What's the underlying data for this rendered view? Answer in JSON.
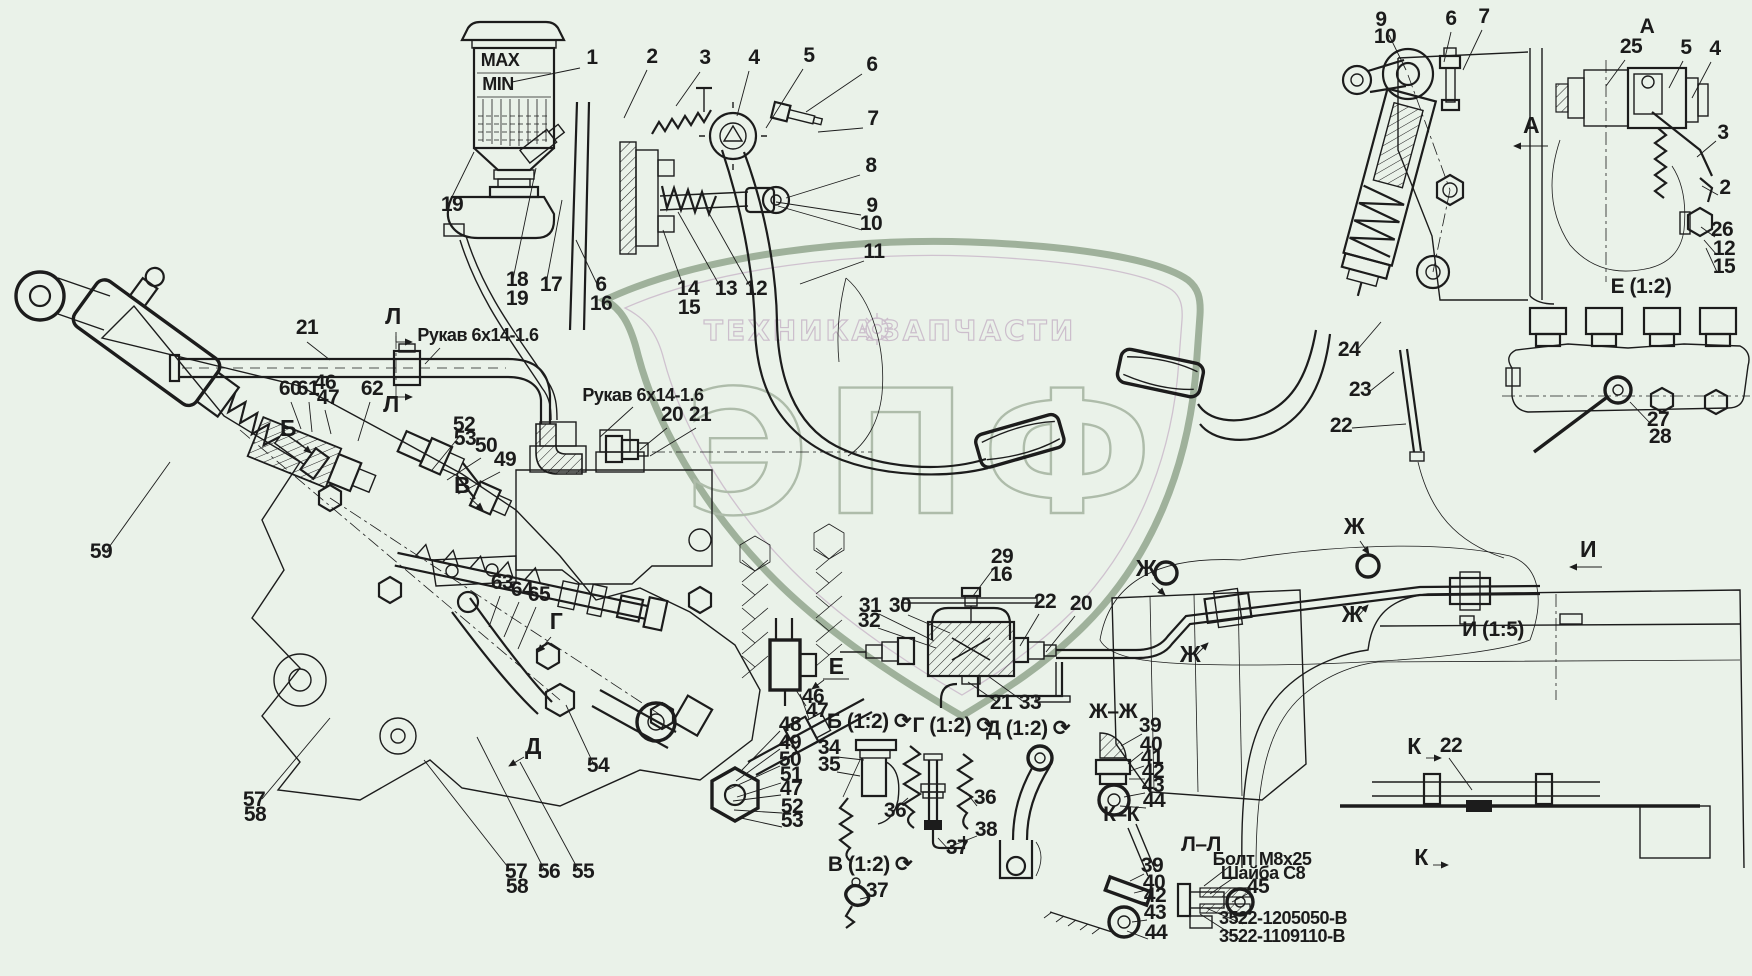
{
  "page": {
    "bg": "#eaf2e9",
    "ink": "#1b1b1b",
    "kind": "technical parts diagram"
  },
  "watermark": {
    "brand_left": "ТЕХНИКА",
    "brand_right": "ЗАПЧАСТИ",
    "logo_letters": "ЭПФ",
    "shield_color": "#9fb19b",
    "text_color": "#ccbecc",
    "letters_color": "#aebcaa",
    "gear_icon": "gear-icon"
  },
  "annotations": {
    "part_labels": [
      [
        "1",
        592,
        64
      ],
      [
        "2",
        652,
        63
      ],
      [
        "3",
        705,
        64
      ],
      [
        "4",
        754,
        64
      ],
      [
        "5",
        809,
        62
      ],
      [
        "6",
        872,
        71
      ],
      [
        "7",
        873,
        125
      ],
      [
        "8",
        871,
        172
      ],
      [
        "9",
        872,
        212
      ],
      [
        "10",
        871,
        230
      ],
      [
        "11",
        874,
        258
      ],
      [
        "12",
        756,
        295
      ],
      [
        "13",
        726,
        295
      ],
      [
        "14",
        688,
        295
      ],
      [
        "15",
        689,
        314
      ],
      [
        "6",
        601,
        291
      ],
      [
        "16",
        601,
        310
      ],
      [
        "17",
        551,
        291
      ],
      [
        "18",
        517,
        286
      ],
      [
        "19",
        517,
        305
      ],
      [
        "19",
        452,
        211
      ],
      [
        "21",
        307,
        334
      ],
      [
        "59",
        101,
        558
      ],
      [
        "60",
        290,
        395
      ],
      [
        "61",
        308,
        395
      ],
      [
        "46",
        325,
        389
      ],
      [
        "47",
        328,
        404
      ],
      [
        "62",
        372,
        395
      ],
      [
        "52",
        464,
        431
      ],
      [
        "53",
        465,
        445
      ],
      [
        "50",
        486,
        452
      ],
      [
        "49",
        505,
        466
      ],
      [
        "63",
        502,
        589
      ],
      [
        "64",
        522,
        596
      ],
      [
        "65",
        539,
        601
      ],
      [
        "54",
        598,
        772
      ],
      [
        "57",
        254,
        806
      ],
      [
        "58",
        255,
        821
      ],
      [
        "57",
        516,
        878
      ],
      [
        "58",
        517,
        893
      ],
      [
        "56",
        549,
        878
      ],
      [
        "55",
        583,
        878
      ],
      [
        "48",
        790,
        731
      ],
      [
        "49",
        790,
        749
      ],
      [
        "50",
        790,
        766
      ],
      [
        "51",
        791,
        781
      ],
      [
        "47",
        791,
        795
      ],
      [
        "52",
        792,
        813
      ],
      [
        "53",
        792,
        827
      ],
      [
        "46",
        813,
        703
      ],
      [
        "47",
        817,
        717
      ],
      [
        "34",
        829,
        754
      ],
      [
        "35",
        829,
        771
      ],
      [
        "36",
        895,
        817
      ],
      [
        "36",
        985,
        804
      ],
      [
        "38",
        986,
        836
      ],
      [
        "37",
        957,
        854
      ],
      [
        "37",
        877,
        897
      ],
      [
        "29",
        1002,
        563
      ],
      [
        "16",
        1001,
        581
      ],
      [
        "31",
        870,
        612
      ],
      [
        "32",
        869,
        627
      ],
      [
        "30",
        900,
        612
      ],
      [
        "22",
        1045,
        608
      ],
      [
        "20",
        1081,
        610
      ],
      [
        "21",
        1001,
        709
      ],
      [
        "33",
        1030,
        709
      ],
      [
        "20",
        672,
        421
      ],
      [
        "21",
        700,
        421
      ],
      [
        "39",
        1150,
        732
      ],
      [
        "40",
        1151,
        751
      ],
      [
        "41",
        1152,
        764
      ],
      [
        "42",
        1153,
        778
      ],
      [
        "43",
        1153,
        792
      ],
      [
        "44",
        1154,
        807
      ],
      [
        "39",
        1152,
        872
      ],
      [
        "40",
        1154,
        889
      ],
      [
        "42",
        1155,
        902
      ],
      [
        "43",
        1155,
        919
      ],
      [
        "44",
        1156,
        939
      ],
      [
        "45",
        1258,
        893
      ],
      [
        "24",
        1349,
        356
      ],
      [
        "23",
        1360,
        396
      ],
      [
        "22",
        1341,
        432
      ],
      [
        "9",
        1381,
        26
      ],
      [
        "10",
        1385,
        43
      ],
      [
        "6",
        1451,
        25
      ],
      [
        "7",
        1484,
        23
      ],
      [
        "25",
        1631,
        53
      ],
      [
        "5",
        1686,
        54
      ],
      [
        "4",
        1715,
        55
      ],
      [
        "3",
        1723,
        139
      ],
      [
        "2",
        1725,
        194
      ],
      [
        "26",
        1722,
        236
      ],
      [
        "12",
        1724,
        255
      ],
      [
        "15",
        1724,
        273
      ],
      [
        "27",
        1658,
        426
      ],
      [
        "28",
        1660,
        443
      ],
      [
        "22",
        1451,
        752
      ]
    ],
    "view_titles": [
      [
        "А",
        1647,
        33,
        26
      ],
      [
        "Е (1:2)",
        1641,
        293
      ],
      [
        "И (1:5)",
        1493,
        636,
        23
      ],
      [
        "Б (1:2) ⟳",
        869,
        728
      ],
      [
        "Г (1:2) ⟳",
        953,
        732
      ],
      [
        "Д (1:2) ⟳",
        1028,
        735
      ],
      [
        "В (1:2) ⟳",
        870,
        871
      ],
      [
        "Ж–Ж",
        1113,
        718,
        22
      ],
      [
        "К–К",
        1121,
        821,
        22
      ],
      [
        "Л–Л",
        1201,
        851,
        22
      ]
    ],
    "section_markers": [
      [
        "Л",
        393,
        324
      ],
      [
        "Л",
        391,
        412
      ],
      [
        "Б",
        288,
        436
      ],
      [
        "В",
        462,
        493
      ],
      [
        "Г",
        556,
        629
      ],
      [
        "Д",
        533,
        754
      ],
      [
        "Е",
        836,
        674
      ],
      [
        "А",
        1531,
        133
      ],
      [
        "И",
        1588,
        557
      ],
      [
        "Ж",
        1146,
        576
      ],
      [
        "Ж",
        1190,
        662
      ],
      [
        "Ж",
        1354,
        534
      ],
      [
        "Ж",
        1352,
        622
      ],
      [
        "К",
        1414,
        754
      ],
      [
        "К",
        1421,
        865
      ]
    ],
    "notes": [
      [
        "MAX",
        500,
        66,
        12
      ],
      [
        "MIN",
        498,
        90,
        12
      ],
      [
        "Рукав 6х14-1.6",
        478,
        341
      ],
      [
        "Рукав 6х14-1.6",
        643,
        401
      ],
      [
        "Болт М8х25",
        1262,
        865,
        16
      ],
      [
        "Шайба С8",
        1263,
        879,
        16
      ],
      [
        "3522-1205050-В",
        1283,
        924,
        17
      ],
      [
        "3522-1109110-В",
        1282,
        942,
        17
      ]
    ]
  },
  "leaders": [
    [
      580,
      68,
      512,
      82
    ],
    [
      647,
      70,
      624,
      118
    ],
    [
      700,
      72,
      676,
      106
    ],
    [
      749,
      71,
      737,
      116
    ],
    [
      803,
      69,
      766,
      128
    ],
    [
      862,
      74,
      806,
      112
    ],
    [
      863,
      128,
      818,
      132
    ],
    [
      860,
      175,
      786,
      198
    ],
    [
      861,
      215,
      776,
      202
    ],
    [
      862,
      230,
      778,
      206
    ],
    [
      864,
      261,
      800,
      284
    ],
    [
      751,
      288,
      706,
      208
    ],
    [
      721,
      288,
      678,
      212
    ],
    [
      684,
      288,
      663,
      230
    ],
    [
      597,
      284,
      576,
      240
    ],
    [
      546,
      284,
      562,
      200
    ],
    [
      513,
      279,
      536,
      168
    ],
    [
      449,
      203,
      474,
      152
    ],
    [
      307,
      342,
      330,
      360
    ],
    [
      440,
      348,
      425,
      364
    ],
    [
      633,
      407,
      600,
      437
    ],
    [
      667,
      428,
      640,
      450
    ],
    [
      696,
      428,
      650,
      456
    ],
    [
      107,
      550,
      170,
      462
    ],
    [
      291,
      402,
      301,
      429
    ],
    [
      309,
      402,
      312,
      432
    ],
    [
      325,
      410,
      331,
      434
    ],
    [
      370,
      402,
      358,
      441
    ],
    [
      459,
      437,
      432,
      470
    ],
    [
      481,
      458,
      447,
      480
    ],
    [
      500,
      472,
      458,
      494
    ],
    [
      500,
      596,
      489,
      627
    ],
    [
      519,
      602,
      504,
      637
    ],
    [
      536,
      607,
      518,
      649
    ],
    [
      594,
      765,
      566,
      705
    ],
    [
      262,
      799,
      330,
      718
    ],
    [
      511,
      871,
      424,
      760
    ],
    [
      545,
      871,
      477,
      737
    ],
    [
      579,
      871,
      520,
      762
    ],
    [
      780,
      731,
      742,
      770
    ],
    [
      780,
      749,
      736,
      781
    ],
    [
      780,
      766,
      727,
      790
    ],
    [
      781,
      783,
      737,
      797
    ],
    [
      781,
      795,
      733,
      801
    ],
    [
      782,
      813,
      734,
      810
    ],
    [
      782,
      827,
      741,
      818
    ],
    [
      806,
      706,
      796,
      690
    ],
    [
      809,
      719,
      800,
      694
    ],
    [
      837,
      757,
      864,
      760
    ],
    [
      837,
      772,
      860,
      776
    ],
    [
      893,
      811,
      908,
      798
    ],
    [
      977,
      806,
      966,
      792
    ],
    [
      977,
      836,
      954,
      845
    ],
    [
      950,
      851,
      938,
      838
    ],
    [
      869,
      897,
      860,
      899
    ],
    [
      994,
      568,
      973,
      596
    ],
    [
      879,
      614,
      934,
      641
    ],
    [
      878,
      628,
      936,
      648
    ],
    [
      908,
      615,
      950,
      633
    ],
    [
      1039,
      614,
      1020,
      646
    ],
    [
      1075,
      616,
      1046,
      652
    ],
    [
      997,
      702,
      968,
      682
    ],
    [
      1024,
      702,
      988,
      676
    ],
    [
      1142,
      734,
      1121,
      746
    ],
    [
      1143,
      752,
      1128,
      764
    ],
    [
      1144,
      766,
      1130,
      771
    ],
    [
      1145,
      779,
      1129,
      779
    ],
    [
      1145,
      793,
      1124,
      797
    ],
    [
      1146,
      808,
      1120,
      806
    ],
    [
      1144,
      874,
      1130,
      881
    ],
    [
      1146,
      890,
      1134,
      893
    ],
    [
      1147,
      903,
      1137,
      901
    ],
    [
      1147,
      920,
      1132,
      922
    ],
    [
      1148,
      939,
      1127,
      931
    ],
    [
      1230,
      866,
      1204,
      886
    ],
    [
      1232,
      879,
      1210,
      894
    ],
    [
      1249,
      893,
      1232,
      902
    ],
    [
      1243,
      924,
      1206,
      908
    ],
    [
      1242,
      941,
      1200,
      914
    ],
    [
      1357,
      350,
      1381,
      322
    ],
    [
      1369,
      392,
      1394,
      372
    ],
    [
      1352,
      428,
      1406,
      424
    ],
    [
      1389,
      35,
      1406,
      70
    ],
    [
      1451,
      32,
      1444,
      62
    ],
    [
      1482,
      30,
      1463,
      70
    ],
    [
      1625,
      60,
      1606,
      86
    ],
    [
      1683,
      61,
      1669,
      88
    ],
    [
      1711,
      62,
      1692,
      98
    ],
    [
      1716,
      141,
      1697,
      157
    ],
    [
      1718,
      195,
      1702,
      186
    ],
    [
      1715,
      237,
      1701,
      227
    ],
    [
      1717,
      255,
      1704,
      240
    ],
    [
      1717,
      272,
      1706,
      248
    ],
    [
      1650,
      423,
      1630,
      402
    ],
    [
      1449,
      758,
      1472,
      790
    ],
    [
      396,
      332,
      396,
      342
    ],
    [
      396,
      407,
      396,
      397
    ],
    [
      823,
      679,
      849,
      679
    ]
  ],
  "arrows": [
    [
      1548,
      146,
      1514,
      146
    ],
    [
      1602,
      567,
      1570,
      567
    ],
    [
      396,
      342,
      412,
      342
    ],
    [
      396,
      397,
      412,
      397
    ],
    [
      297,
      441,
      311,
      453
    ],
    [
      470,
      498,
      483,
      510
    ],
    [
      551,
      637,
      538,
      652
    ],
    [
      524,
      757,
      509,
      766
    ],
    [
      824,
      680,
      812,
      689
    ],
    [
      1152,
      583,
      1165,
      595
    ],
    [
      1196,
      655,
      1208,
      643
    ],
    [
      1360,
      541,
      1369,
      554
    ],
    [
      1358,
      616,
      1368,
      605
    ],
    [
      1426,
      758,
      1441,
      758
    ],
    [
      1433,
      865,
      1448,
      865
    ]
  ]
}
